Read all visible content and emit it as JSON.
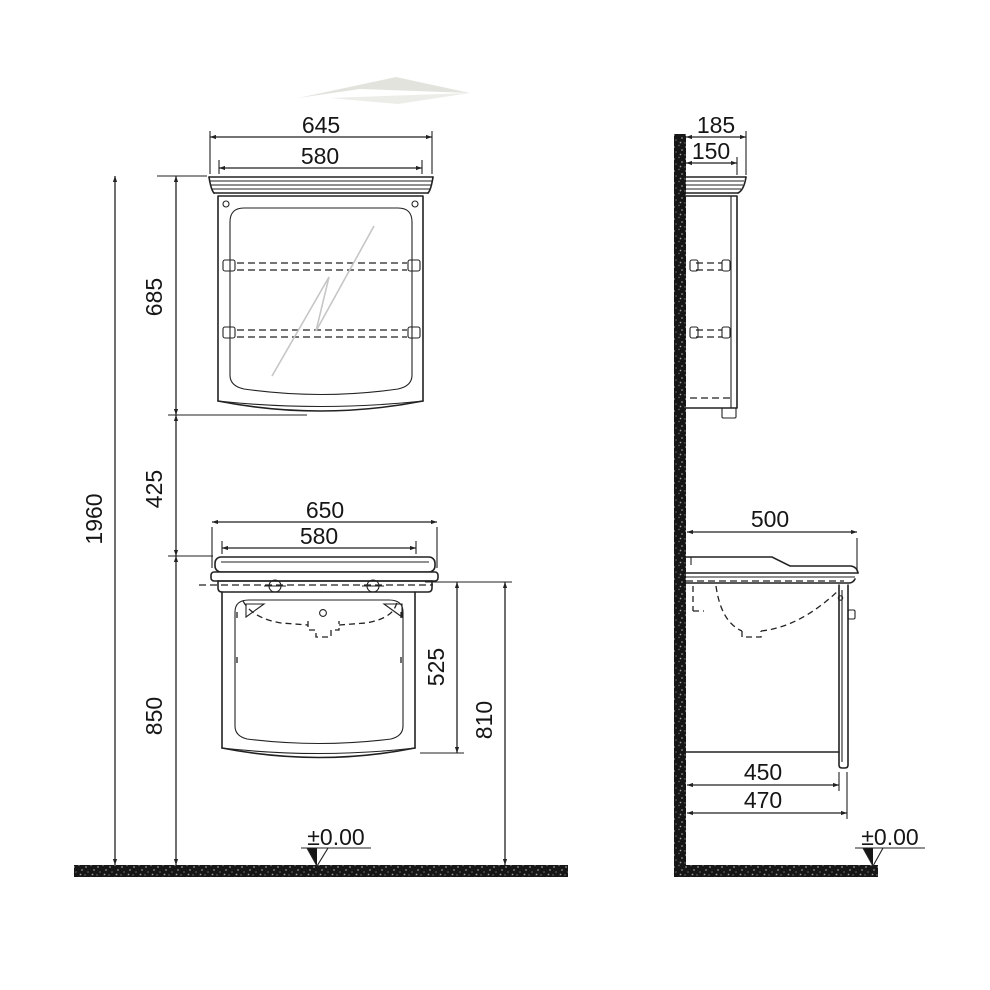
{
  "drawing": {
    "subject": "Bathroom furniture technical drawing — mirror cabinet and washbasin vanity unit, front and side elevations",
    "units": "mm",
    "line_color": "#222222",
    "background": "#ffffff"
  },
  "front_elevation": {
    "mirror_cabinet": {
      "overall_width": "645",
      "body_width": "580",
      "height": "685"
    },
    "washbasin_unit": {
      "overall_width": "650",
      "body_width": "580",
      "cabinet_height": "525",
      "clearance_height": "810"
    },
    "total_height": "1960",
    "mirror_to_unit_gap": "425",
    "worktop_height": "850",
    "floor_datum": "±0.00"
  },
  "side_elevation": {
    "mirror_cabinet": {
      "overall_depth": "185",
      "body_depth": "150"
    },
    "washbasin_unit": {
      "basin_depth": "500",
      "cabinet_depth": "450",
      "depth_with_door": "470"
    },
    "floor_datum": "±0.00"
  }
}
